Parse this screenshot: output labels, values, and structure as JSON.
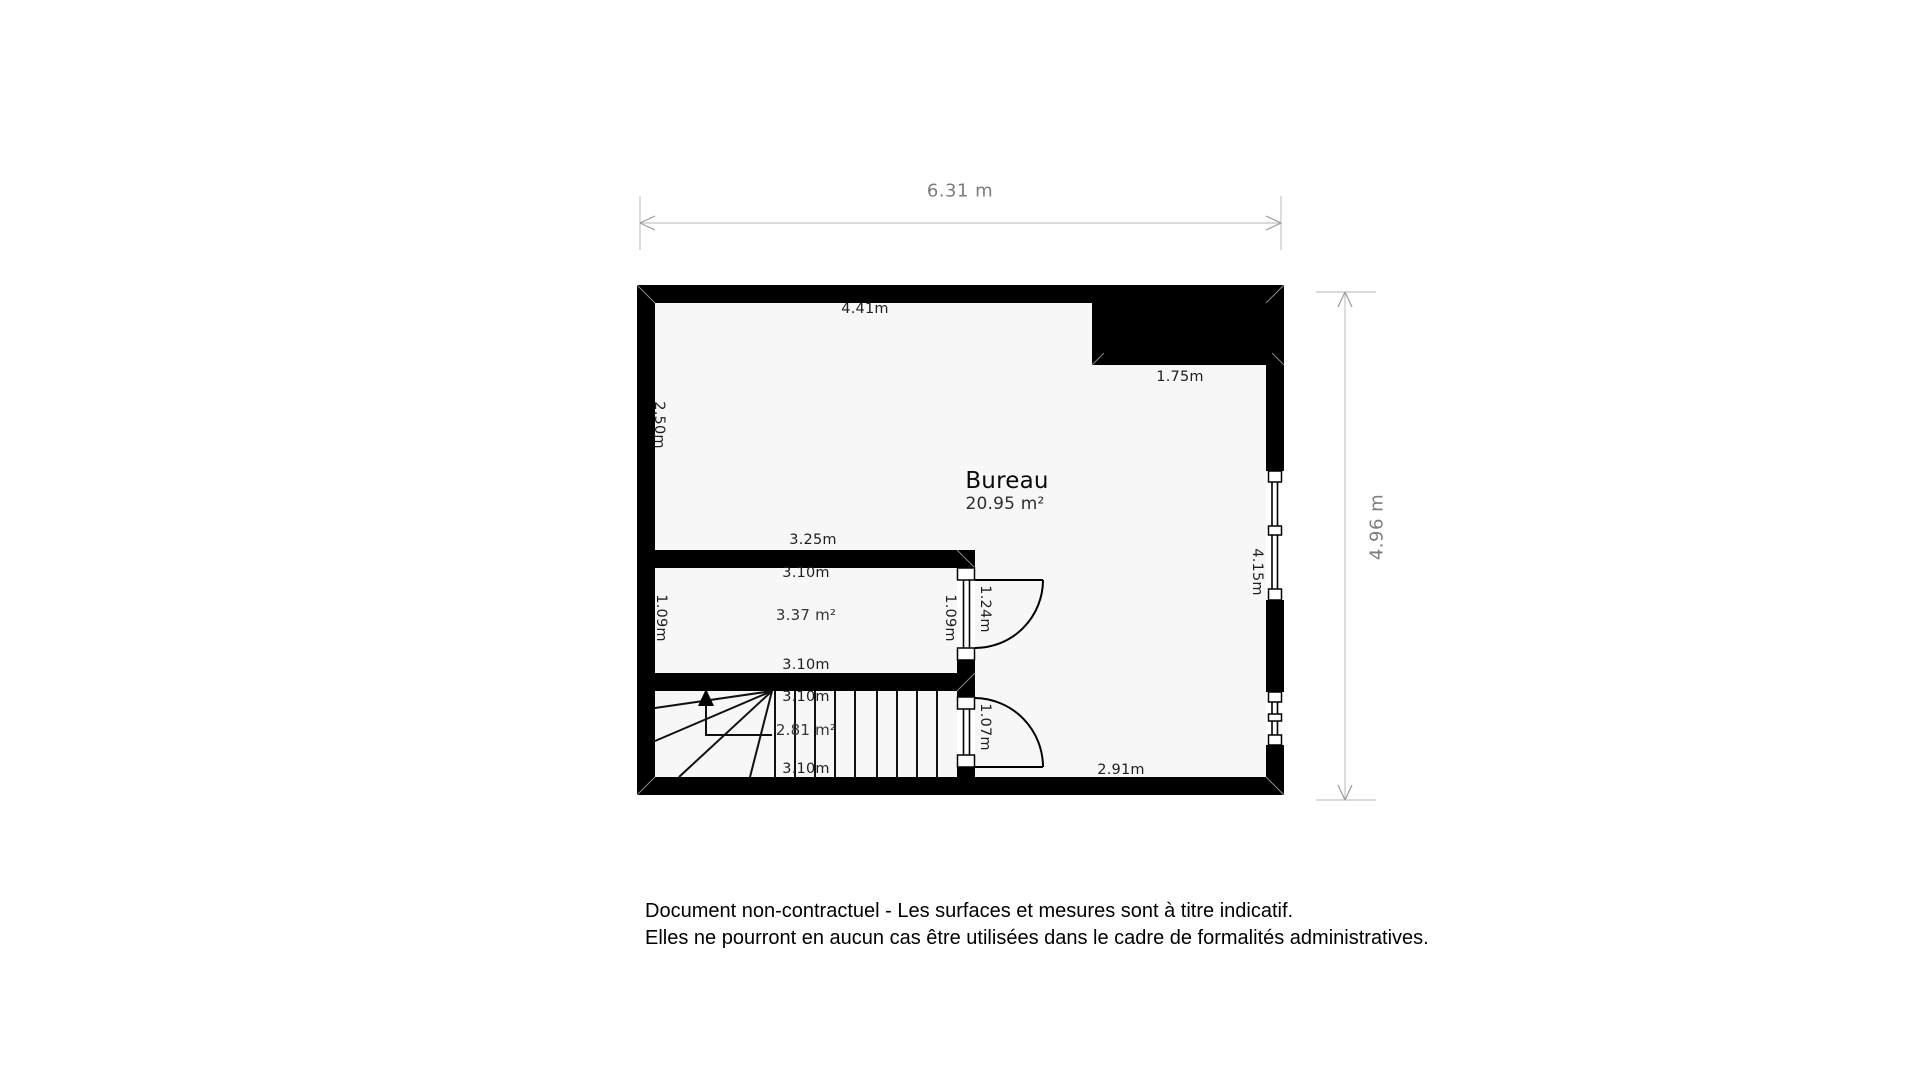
{
  "dimensions": {
    "overall_width": "6.31 m",
    "overall_height": "4.96 m"
  },
  "labels": {
    "top_wall": "4.41m",
    "niche_width": "1.75m",
    "left_upper": "2.50m",
    "inner_width": "3.25m",
    "right_wall": "4.15m",
    "bottom_right": "2.91m"
  },
  "rooms": {
    "bureau": {
      "name": "Bureau",
      "area": "20.95 m²"
    },
    "closet": {
      "area": "3.37 m²",
      "width_top": "3.10m",
      "width_bottom": "3.10m",
      "height_left": "1.09m",
      "height_right": "1.09m"
    },
    "stairs": {
      "area": "2.81 m²",
      "width_top": "3.10m",
      "width_bottom": "3.10m"
    }
  },
  "doors": {
    "closet_door_width": "1.24m",
    "stairs_door_width": "1.07m"
  },
  "footer": {
    "line1": "Document non-contractuel - Les surfaces et mesures sont à titre indicatif.",
    "line2": "Elles ne pourront en aucun cas être utilisées dans le cadre de formalités administratives."
  },
  "colors": {
    "wall": "#000000",
    "floor": "#f7f7f7",
    "dimension_line": "#c4c4c4",
    "dimension_text": "#7d7d7d"
  }
}
